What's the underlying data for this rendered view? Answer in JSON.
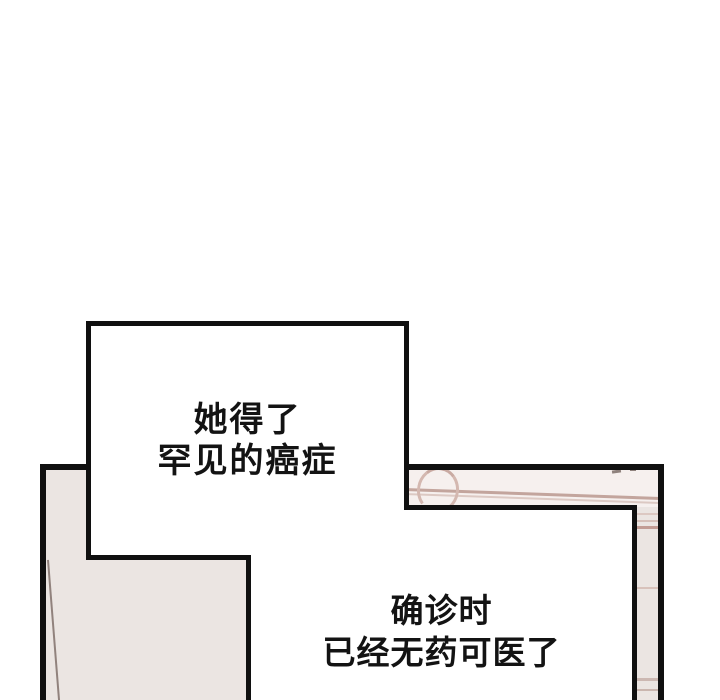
{
  "page": {
    "type": "webtoon-comic-panel",
    "background_color": "#ffffff"
  },
  "colors": {
    "line_art": "#101010",
    "panel_interior": "#ebe5e2",
    "wall_top": "#f6f0ee",
    "wall_accent_line": "#c3a59d",
    "wall_accent_line_light": "#dcc9c3",
    "curtain_line": "#91827d",
    "text": "#131313",
    "bubble_fill": "#ffffff"
  },
  "bubbles": [
    {
      "id": "bubble-top",
      "lines": [
        "她得了",
        "罕见的癌症"
      ]
    },
    {
      "id": "bubble-bottom",
      "lines": [
        "确诊时",
        "已经无药可医了"
      ]
    }
  ]
}
